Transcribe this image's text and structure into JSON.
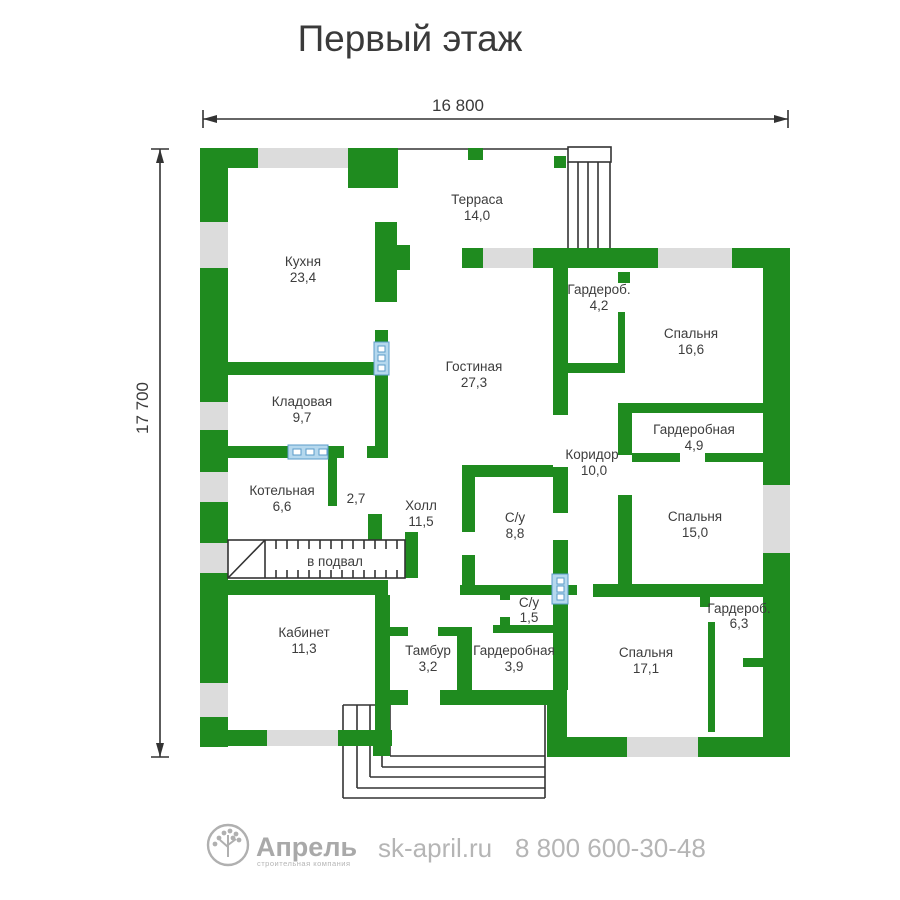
{
  "title": "Первый этаж",
  "dimensions": {
    "width_label": "16 800",
    "height_label": "17 700"
  },
  "rooms": [
    {
      "name": "Терраса",
      "area": "14,0"
    },
    {
      "name": "Кухня",
      "area": "23,4"
    },
    {
      "name": "Гардероб.",
      "area": "4,2"
    },
    {
      "name": "Спальня",
      "area": "16,6"
    },
    {
      "name": "Гостиная",
      "area": "27,3"
    },
    {
      "name": "Кладовая",
      "area": "9,7"
    },
    {
      "name": "Гардеробная",
      "area": "4,9"
    },
    {
      "name": "Коридор",
      "area": "10,0"
    },
    {
      "name": "Котельная",
      "area": "6,6"
    },
    {
      "name": "",
      "area": "2,7"
    },
    {
      "name": "Холл",
      "area": "11,5"
    },
    {
      "name": "С/у",
      "area": "8,8"
    },
    {
      "name": "Спальня",
      "area": "15,0"
    },
    {
      "name": "С/у",
      "area": "1,5"
    },
    {
      "name": "Гардероб.",
      "area": "6,3"
    },
    {
      "name": "Кабинет",
      "area": "11,3"
    },
    {
      "name": "Тамбур",
      "area": "3,2"
    },
    {
      "name": "Гардеробная",
      "area": "3,9"
    },
    {
      "name": "Спальня",
      "area": "17,1"
    }
  ],
  "annotations": {
    "basement_stairs": "в подвал"
  },
  "footer": {
    "brand": "Апрель",
    "tagline": "строительная компания",
    "website": "sk-april.ru",
    "phone": "8 800 600-30-48"
  },
  "colors": {
    "wall": "#1f8b1f",
    "window": "#dcdcdc",
    "glass": "#b5d8ee",
    "glass_border": "#5b9bc8",
    "text": "#3d3d3d",
    "muted": "#b3b3b3"
  }
}
